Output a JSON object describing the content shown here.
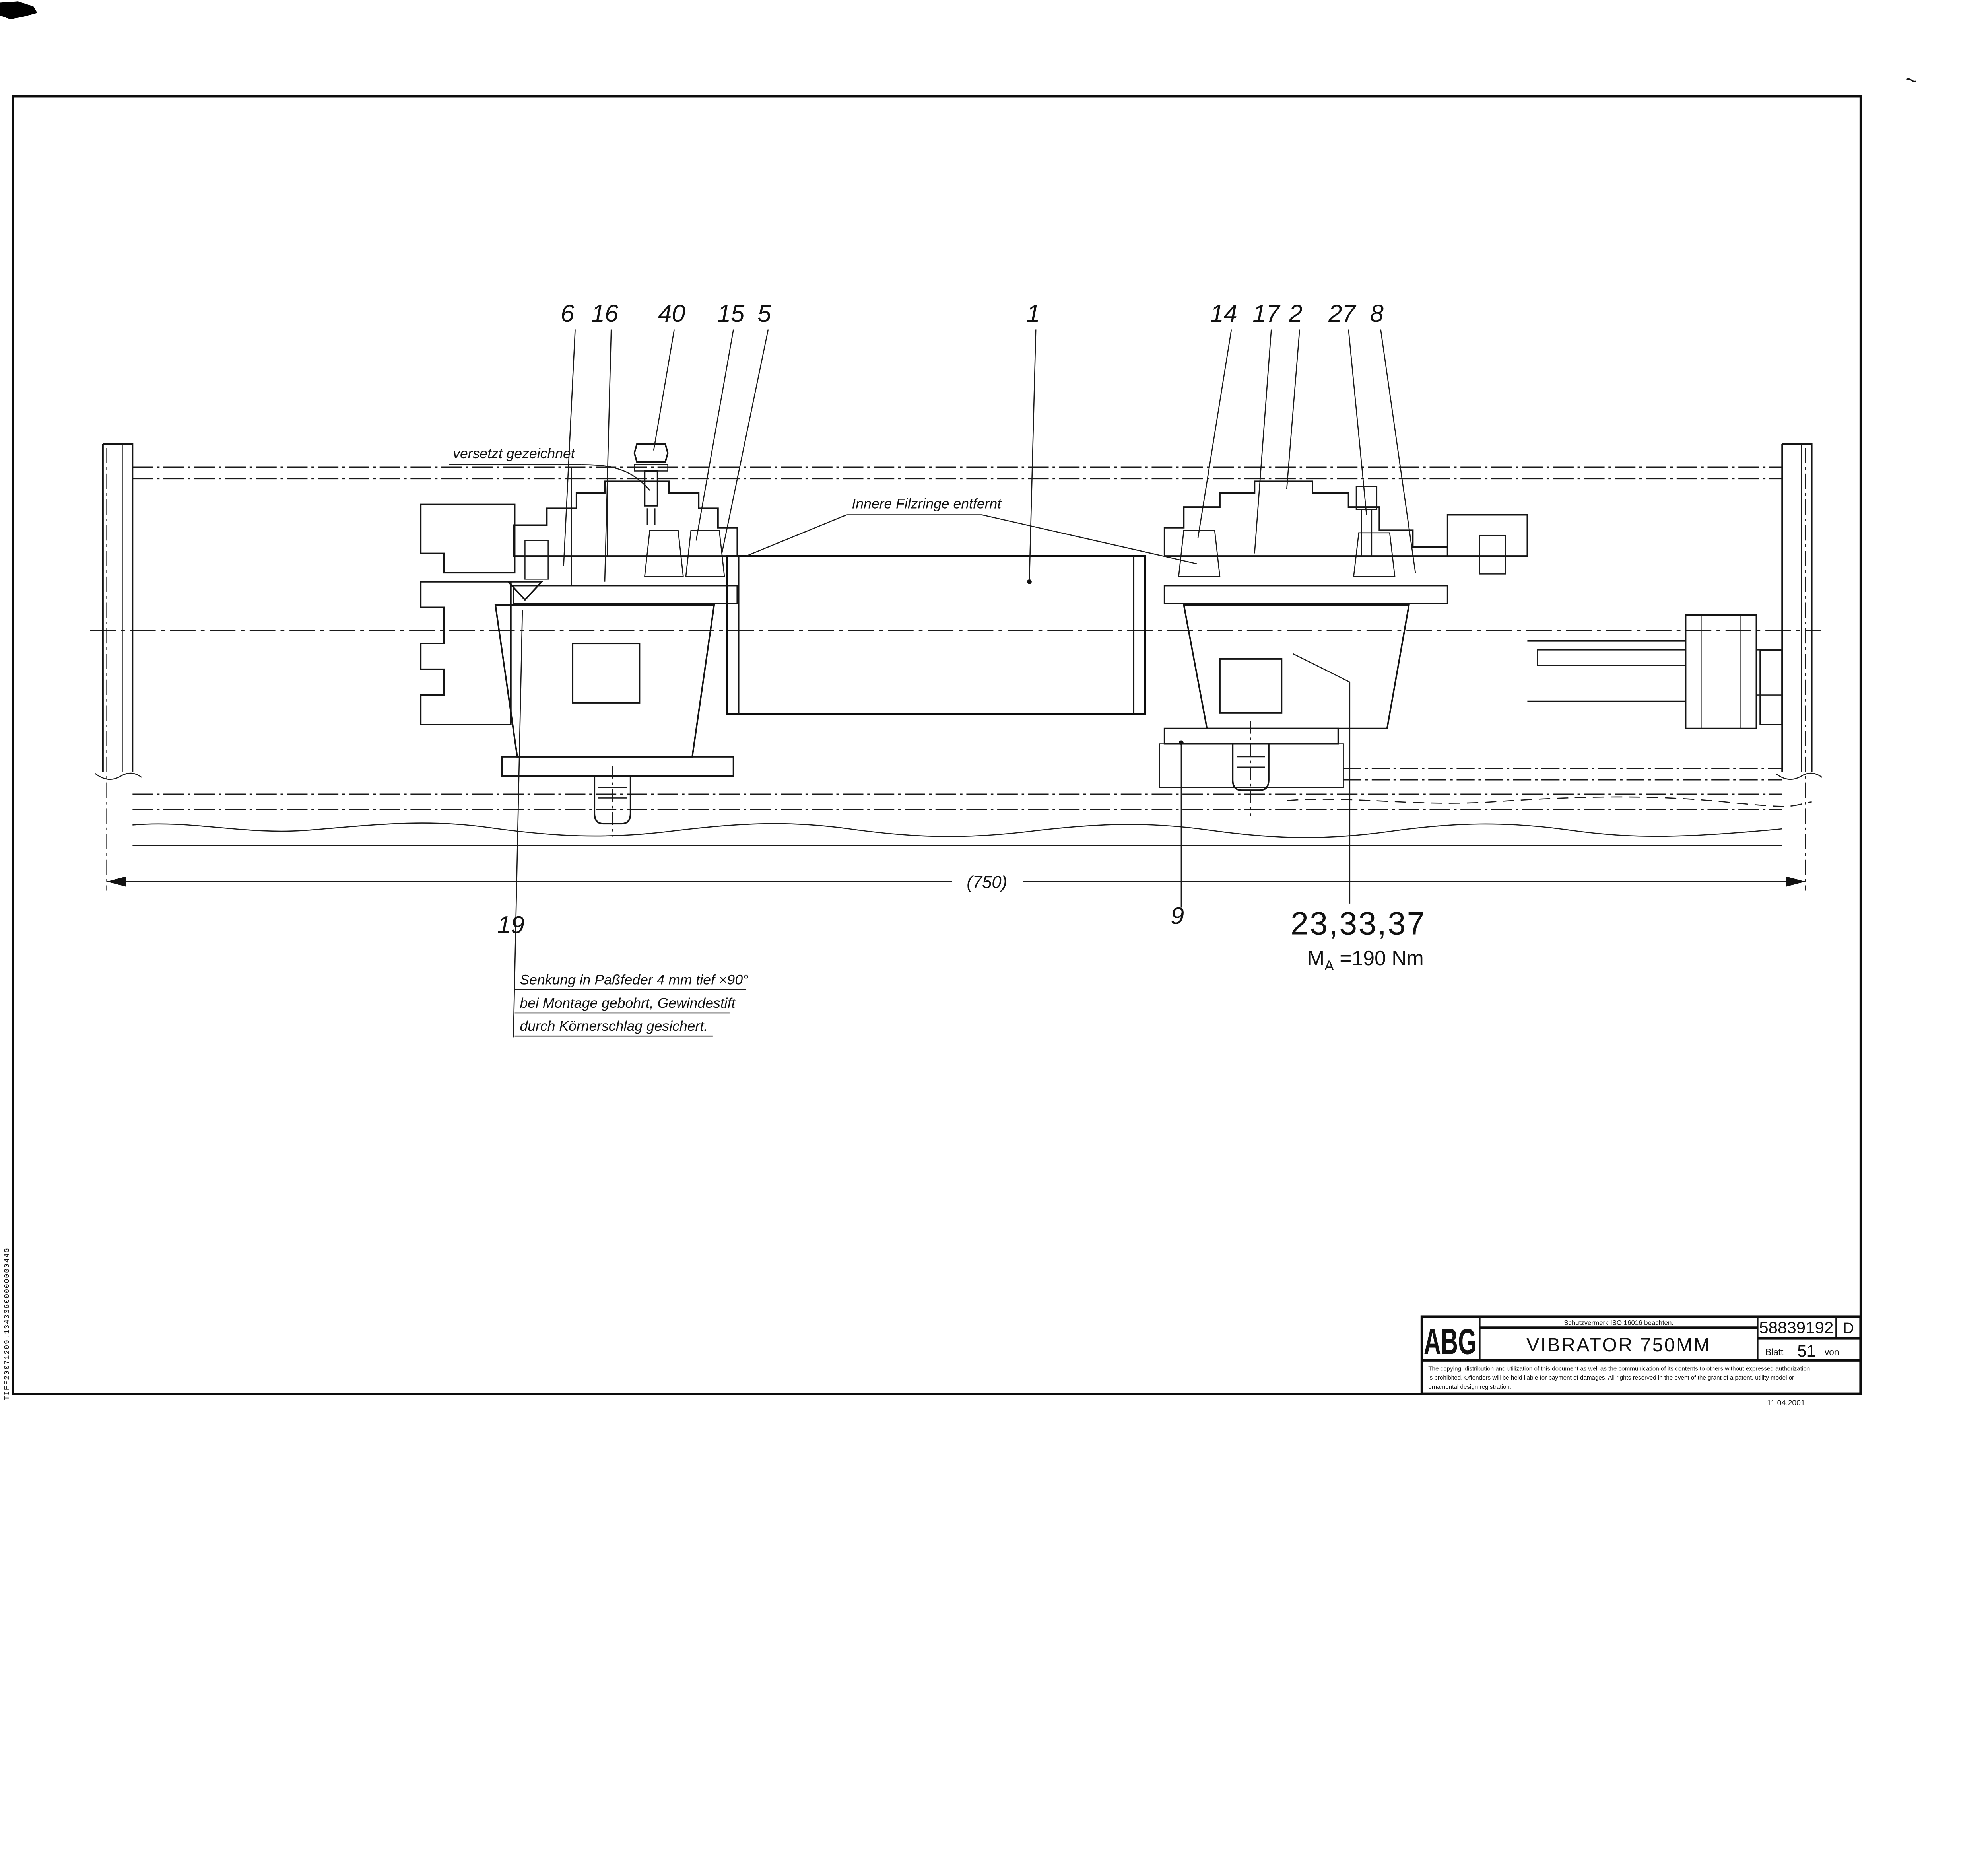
{
  "sheet": {
    "corner_mark": "~",
    "edge_text": "TIFF20071209.1343360000000044G"
  },
  "drawing": {
    "annotations": {
      "versetzt": "versetzt gezeichnet",
      "filzringe": "Innere Filzringe entfernt",
      "dimension_750": "(750)",
      "note_line1": "Senkung in Paßfeder 4 mm tief ×90°",
      "note_line2": "bei Montage gebohrt, Gewindestift",
      "note_line3": "durch Körnerschlag gesichert.",
      "group_label": "23,33,37",
      "torque_m": "M",
      "torque_sub": "A",
      "torque_value": " =190 Nm"
    },
    "part_labels": [
      {
        "id": "6",
        "text": "6"
      },
      {
        "id": "16",
        "text": "16"
      },
      {
        "id": "40",
        "text": "40"
      },
      {
        "id": "15",
        "text": "15"
      },
      {
        "id": "5",
        "text": "5"
      },
      {
        "id": "1",
        "text": "1"
      },
      {
        "id": "14",
        "text": "14"
      },
      {
        "id": "17",
        "text": "17"
      },
      {
        "id": "2",
        "text": "2"
      },
      {
        "id": "27",
        "text": "27"
      },
      {
        "id": "8",
        "text": "8"
      },
      {
        "id": "19",
        "text": "19"
      },
      {
        "id": "9",
        "text": "9"
      }
    ]
  },
  "title_block": {
    "logo": "ABG",
    "protection_note": "Schutzvermerk ISO 16016 beachten.",
    "title": "VIBRATOR 750MM",
    "document_number": "58839192",
    "revision": "D",
    "sheet_label": "Blatt",
    "sheet_number": "51",
    "sheet_of_label": "von",
    "legal_line1": "The copying, distribution and utilization of this document as well as the communication of its contents to others without expressed authorization",
    "legal_line2": "is prohibited. Offenders will be held liable for payment of damages. All rights reserved in the event of the grant of a patent, utility model or",
    "legal_line3": "ornamental design registration.",
    "date": "11.04.2001"
  },
  "colors": {
    "ink": "#111111",
    "paper": "#ffffff"
  }
}
